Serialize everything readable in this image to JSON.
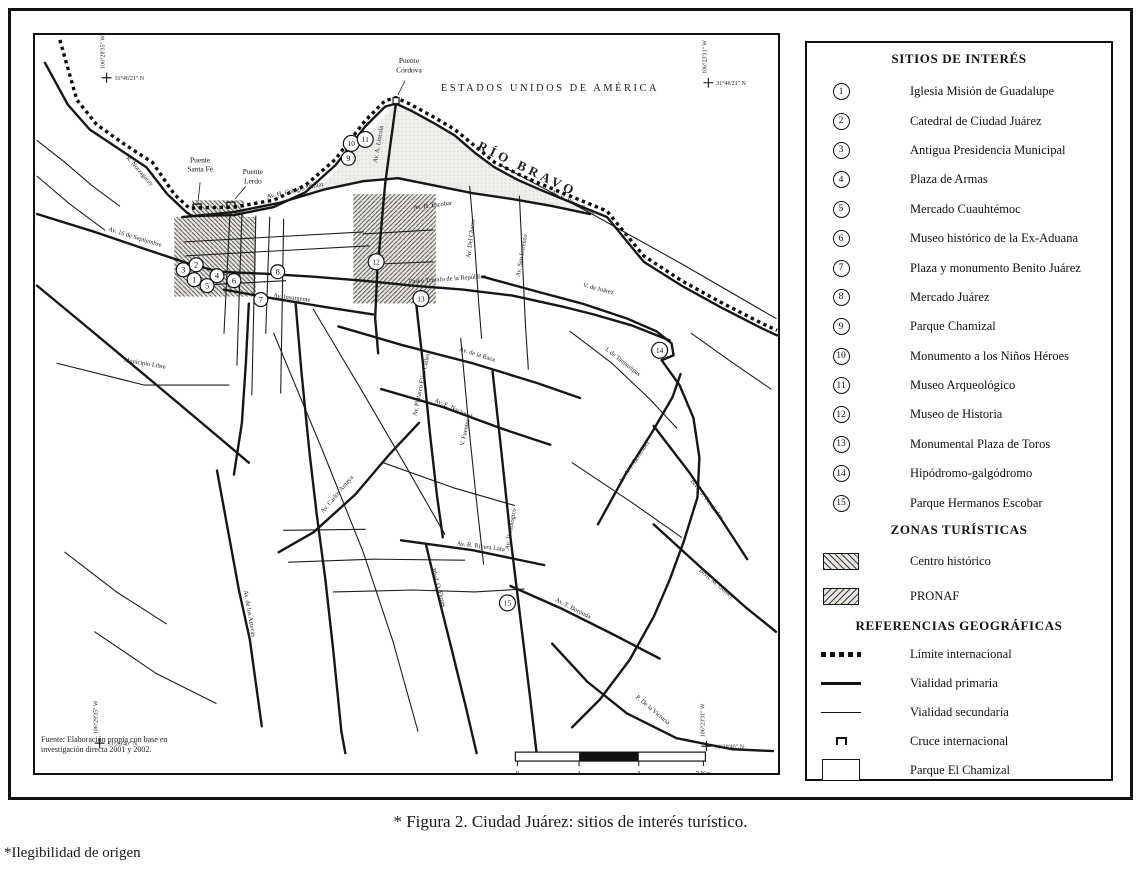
{
  "figure": {
    "caption": "* Figura 2. Ciudad Juárez: sitios de interés turístico.",
    "footnote": "*Ilegibilidad de origen"
  },
  "map": {
    "country_label": "ESTADOS UNIDOS DE AMÉRICA",
    "river_label": "RÍO BRAVO",
    "source_note": [
      "Fuente: Elaboración propia con base en",
      "investigación directa 2001 y 2002."
    ],
    "bridges": [
      {
        "name": "bridge-santa-fe",
        "lines": [
          "Puente",
          "Santa Fé"
        ],
        "lx": 166,
        "ly": 128,
        "sx": 163,
        "sy": 173,
        "leader": [
          166,
          148,
          164,
          167
        ]
      },
      {
        "name": "bridge-lerdo",
        "lines": [
          "Puente",
          "Lerdo"
        ],
        "lx": 219,
        "ly": 140,
        "sx": 197,
        "sy": 171,
        "leader": [
          212,
          152,
          201,
          165
        ]
      },
      {
        "name": "bridge-cordova",
        "lines": [
          "Puente",
          "Córdova"
        ],
        "lx": 376,
        "ly": 28,
        "sx": 363,
        "sy": 66,
        "sq": true,
        "leader": [
          372,
          46,
          365,
          60
        ]
      }
    ],
    "corner_coords": [
      {
        "lat": "31°46'21\" N",
        "lon": "106°28'35\" W",
        "cx": 72,
        "cy": 43
      },
      {
        "lat": "31°46'21\" N",
        "lon": "106°23'31\" W",
        "cx": 677,
        "cy": 48
      },
      {
        "lat": "31°39'40\" N",
        "lon": "106°29'35\" W",
        "cx": 65,
        "cy": 712
      },
      {
        "lat": "31°39'40\" N",
        "lon": "106°23'31\" W",
        "cx": 675,
        "cy": 715
      }
    ],
    "street_labels": [
      {
        "t": "R. Norzagaray",
        "x": 104,
        "y": 138,
        "r": 48
      },
      {
        "t": "Av. 16 de Septiembre",
        "x": 100,
        "y": 205,
        "r": 17
      },
      {
        "t": "Av. H. Colegio Militar",
        "x": 262,
        "y": 158,
        "r": -13
      },
      {
        "t": "Av. A. Lincoln",
        "x": 347,
        "y": 110,
        "r": -80
      },
      {
        "t": "Av. R. Pérez Serna",
        "x": 540,
        "y": 170,
        "r": 27
      },
      {
        "t": "Av. H. Escobar",
        "x": 400,
        "y": 173,
        "r": -7
      },
      {
        "t": "Av. Del Charro",
        "x": 440,
        "y": 205,
        "r": -83
      },
      {
        "t": "Av. San Lorenzo",
        "x": 491,
        "y": 222,
        "r": -80
      },
      {
        "t": "Paseo Triunfo de la República",
        "x": 415,
        "y": 247,
        "r": -4
      },
      {
        "t": "V. de Juárez",
        "x": 566,
        "y": 257,
        "r": 14
      },
      {
        "t": "I. de Tamaulipas",
        "x": 590,
        "y": 330,
        "r": 38
      },
      {
        "t": "Av. de la Raza",
        "x": 444,
        "y": 323,
        "r": 17
      },
      {
        "t": "Av. Plutarco Elías Calles",
        "x": 390,
        "y": 352,
        "r": -78
      },
      {
        "t": "V. Fuentes",
        "x": 434,
        "y": 400,
        "r": -78
      },
      {
        "t": "Av. E. Nacional",
        "x": 420,
        "y": 377,
        "r": 24
      },
      {
        "t": "Av. Insurgente",
        "x": 258,
        "y": 266,
        "r": 7
      },
      {
        "t": "Av. Tecnológico",
        "x": 480,
        "y": 497,
        "r": -80
      },
      {
        "t": "Av. R. Rivera Lara",
        "x": 448,
        "y": 516,
        "r": 7
      },
      {
        "t": "Av. T. Borunda",
        "x": 540,
        "y": 578,
        "r": 27
      },
      {
        "t": "Av. Carlos Amaya",
        "x": 305,
        "y": 463,
        "r": -50
      },
      {
        "t": "Av. de los Aztecas",
        "x": 214,
        "y": 582,
        "r": 80
      },
      {
        "t": "Blvd. O. Flores",
        "x": 404,
        "y": 556,
        "r": 74
      },
      {
        "t": "Blvd. M. Gómez",
        "x": 684,
        "y": 553,
        "r": 40
      },
      {
        "t": "Blvd. T. Fernández",
        "x": 674,
        "y": 468,
        "r": 52
      },
      {
        "t": "Av. A. J. Bermúdez",
        "x": 604,
        "y": 430,
        "r": -56
      },
      {
        "t": "Municipio Libre",
        "x": 110,
        "y": 332,
        "r": 10
      },
      {
        "t": "P. De la Victoria",
        "x": 620,
        "y": 680,
        "r": 40
      }
    ],
    "markers": [
      {
        "n": "1",
        "x": 160,
        "y": 246
      },
      {
        "n": "2",
        "x": 162,
        "y": 231
      },
      {
        "n": "3",
        "x": 149,
        "y": 236
      },
      {
        "n": "4",
        "x": 183,
        "y": 242
      },
      {
        "n": "5",
        "x": 173,
        "y": 252
      },
      {
        "n": "6",
        "x": 200,
        "y": 247
      },
      {
        "n": "7",
        "x": 227,
        "y": 266
      },
      {
        "n": "8",
        "x": 244,
        "y": 238
      },
      {
        "n": "9",
        "x": 315,
        "y": 124
      },
      {
        "n": "10",
        "x": 318,
        "y": 109
      },
      {
        "n": "11",
        "x": 332,
        "y": 105
      },
      {
        "n": "12",
        "x": 343,
        "y": 228
      },
      {
        "n": "13",
        "x": 388,
        "y": 265
      },
      {
        "n": "14",
        "x": 628,
        "y": 317
      },
      {
        "n": "15",
        "x": 475,
        "y": 571
      }
    ],
    "scale": {
      "labels": [
        "0",
        "1",
        "2",
        "3 Km"
      ],
      "xs": [
        485,
        547,
        607,
        672
      ]
    }
  },
  "legend": {
    "sites_title": "SITIOS DE INTERÉS",
    "sites": [
      {
        "num": "1",
        "label": "Iglesia Misión de Guadalupe"
      },
      {
        "num": "2",
        "label": "Catedral de Ciudad Juárez"
      },
      {
        "num": "3",
        "label": "Antigua Presidencia Municipal"
      },
      {
        "num": "4",
        "label": "Plaza de Armas"
      },
      {
        "num": "5",
        "label": "Mercado Cuauhtémoc"
      },
      {
        "num": "6",
        "label": "Museo histórico de la Ex-Aduana"
      },
      {
        "num": "7",
        "label": "Plaza y monumento Benito Juárez"
      },
      {
        "num": "8",
        "label": "Mercado Juárez"
      },
      {
        "num": "9",
        "label": "Parque Chamizal"
      },
      {
        "num": "10",
        "label": "Monumento a los Niños Héroes"
      },
      {
        "num": "11",
        "label": "Museo Arqueológico"
      },
      {
        "num": "12",
        "label": "Museo de Historia"
      },
      {
        "num": "13",
        "label": "Monumental Plaza de Toros"
      },
      {
        "num": "14",
        "label": "Hipódromo-galgódromo"
      },
      {
        "num": "15",
        "label": "Parque Hermanos Escobar"
      }
    ],
    "zones_title": "ZONAS TURÍSTICAS",
    "zones": [
      {
        "label": "Centro histórico",
        "hatch": "back"
      },
      {
        "label": "PRONAF",
        "hatch": "fwd"
      }
    ],
    "refs_title": "REFERENCIAS GEOGRÁFICAS",
    "refs": [
      {
        "label": "Límite internacional",
        "symbol": "dotted"
      },
      {
        "label": "Vialidad primaria",
        "symbol": "thick"
      },
      {
        "label": "Vialidad secundaria",
        "symbol": "thin"
      },
      {
        "label": "Cruce internacional",
        "symbol": "bridge"
      },
      {
        "label": "Parque El Chamizal",
        "symbol": "whitebox"
      }
    ]
  }
}
